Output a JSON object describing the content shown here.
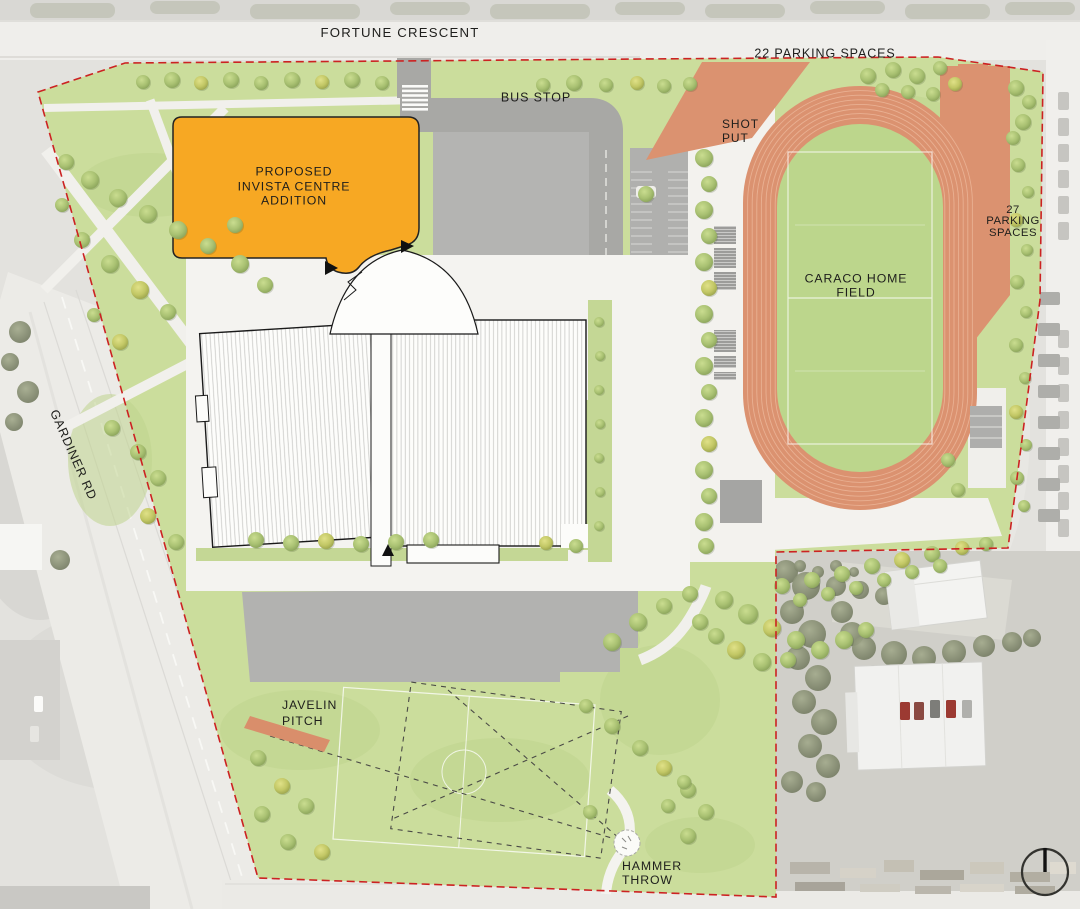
{
  "page": {
    "type": "athletic-campus-site-plan"
  },
  "labels": {
    "fortune_crescent": "FORTUNE CRESCENT",
    "gardiner_rd": "GARDINER RD",
    "bus_stop": "BUS STOP",
    "parking_north": "22 PARKING SPACES",
    "parking_east": {
      "lines": [
        "27",
        "PARKING",
        "SPACES"
      ]
    },
    "proposed_addition": {
      "lines": [
        "PROPOSED",
        "INVISTA CENTRE",
        "ADDITION"
      ]
    },
    "shot_put": {
      "lines": [
        "SHOT",
        "PUT"
      ]
    },
    "caraco_home_field": {
      "lines": [
        "CARACO HOME",
        "FIELD"
      ]
    },
    "javelin_pitch": {
      "lines": [
        "JAVELIN",
        "PITCH"
      ]
    },
    "hammer_throw": {
      "lines": [
        "HAMMER",
        "THROW"
      ]
    }
  },
  "colors": {
    "proposed_addition_fill": "#F7A823",
    "running_track": "#DB9270",
    "infield_green": "#BCD68C",
    "site_green": "#CBDD9C",
    "property_boundary": "#CC2222"
  },
  "compass": {
    "icon": "north-arrow"
  }
}
